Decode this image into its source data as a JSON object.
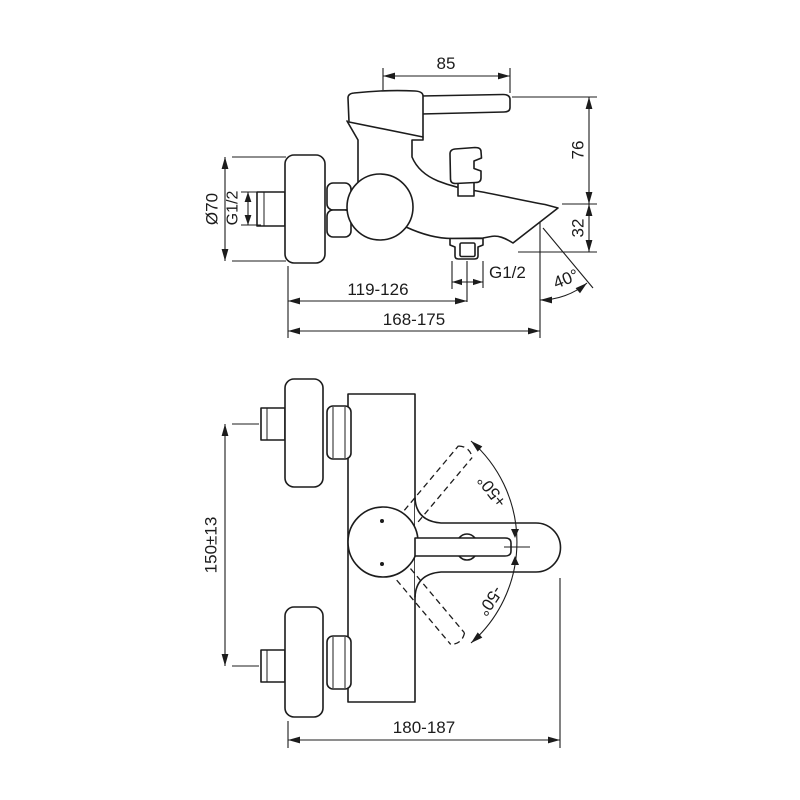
{
  "drawing": {
    "side_view": {
      "dim_85": "85",
      "dim_76": "76",
      "dim_32": "32",
      "flange_dia": "Ø70",
      "inlet_thread": "G1/2",
      "outlet_thread": "G1/2",
      "dim_119_126": "119-126",
      "dim_168_175": "168-175",
      "spout_angle": "40°"
    },
    "plan_view": {
      "dim_150": "150±13",
      "swing_plus": "+50°",
      "swing_minus": "-50°",
      "dim_180_187": "180-187"
    },
    "colors": {
      "line": "#1c1c1c",
      "background": "#ffffff"
    }
  }
}
